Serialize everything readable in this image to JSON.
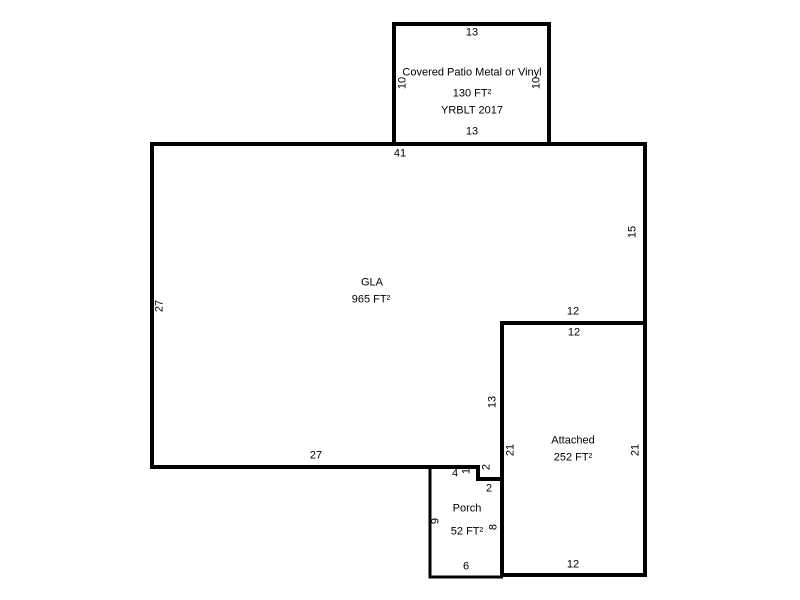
{
  "canvas": {
    "background_color": "#ffffff",
    "line_color": "#000000",
    "text_color": "#000000"
  },
  "patio": {
    "name": "Covered Patio Metal or Vinyl",
    "area": "130 FT²",
    "yrblt": "YRBLT 2017",
    "dims": {
      "top": "13",
      "bottom": "13",
      "left": "10",
      "right": "10"
    }
  },
  "gla": {
    "name": "GLA",
    "area": "965 FT²",
    "dims": {
      "top": "41",
      "left": "27",
      "right": "15",
      "bottom": "27"
    }
  },
  "attached": {
    "name": "Attached",
    "area": "252 FT²",
    "dims": {
      "top_outside": "12",
      "top_inside": "12",
      "left_outside": "13",
      "left_inside": "21",
      "right": "21",
      "bottom": "12"
    }
  },
  "porch": {
    "name": "Porch",
    "area": "52 FT²",
    "dims": {
      "top": "4",
      "left": "9",
      "right": "8",
      "bottom": "6",
      "step_vertical": "1",
      "step_horizontal_outside": "2",
      "step_horizontal_inside": "2"
    }
  }
}
